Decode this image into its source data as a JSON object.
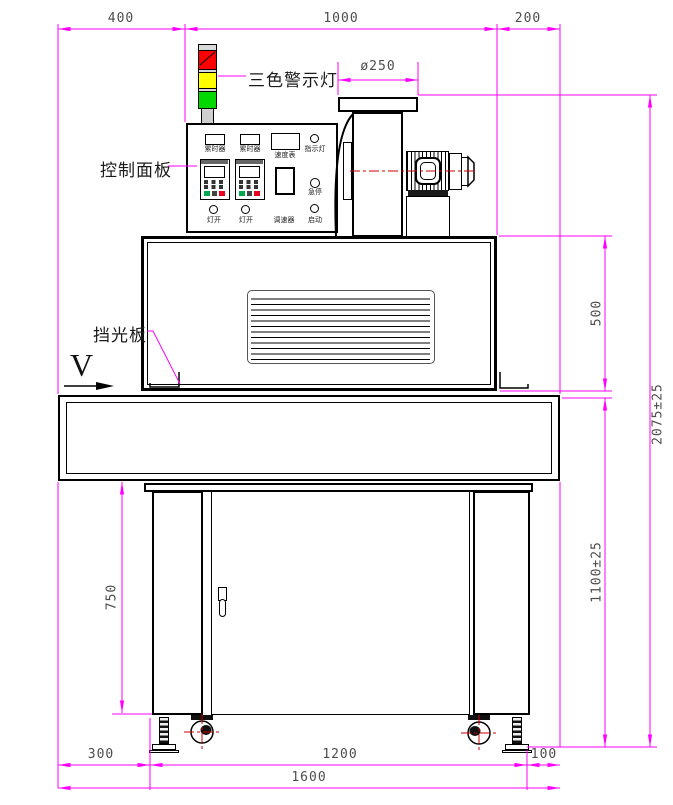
{
  "drawing": {
    "annotations": {
      "tower_light": "三色警示灯",
      "control_panel": "控制面板",
      "light_shield": "挡光板",
      "direction": "V"
    },
    "control_panel_labels": {
      "timer_left": "累时器",
      "timer_right": "累时器",
      "speed_meter": "速度表",
      "indicator_lamp": "指示灯",
      "emergency_stop": "急停",
      "lamp_switch_left": "灯开",
      "lamp_switch_right": "灯开",
      "speed_regulator": "调速器",
      "start": "启动"
    },
    "dimensions": {
      "top_left": "400",
      "top_middle": "1000",
      "top_right": "200",
      "fan_outlet_diameter": "ø250",
      "oven_height": "500",
      "overall_height": "2075±25",
      "table_height": "1100±25",
      "stand_height": "750",
      "bottom_left": "300",
      "bottom_middle": "1200",
      "bottom_right": "100",
      "overall_width": "1600"
    },
    "colors": {
      "dimension_line": "#ff00ff",
      "outline": "#000000",
      "centerline": "#cc0000",
      "dimension_text": "#4d4d4d",
      "warning_red": "#ff0000",
      "warning_yellow": "#ffff00",
      "warning_green": "#00d800",
      "tower_gray": "#d9d9d9",
      "vfd_green_button": "#00a650",
      "vfd_red_button": "#e8001d"
    }
  }
}
